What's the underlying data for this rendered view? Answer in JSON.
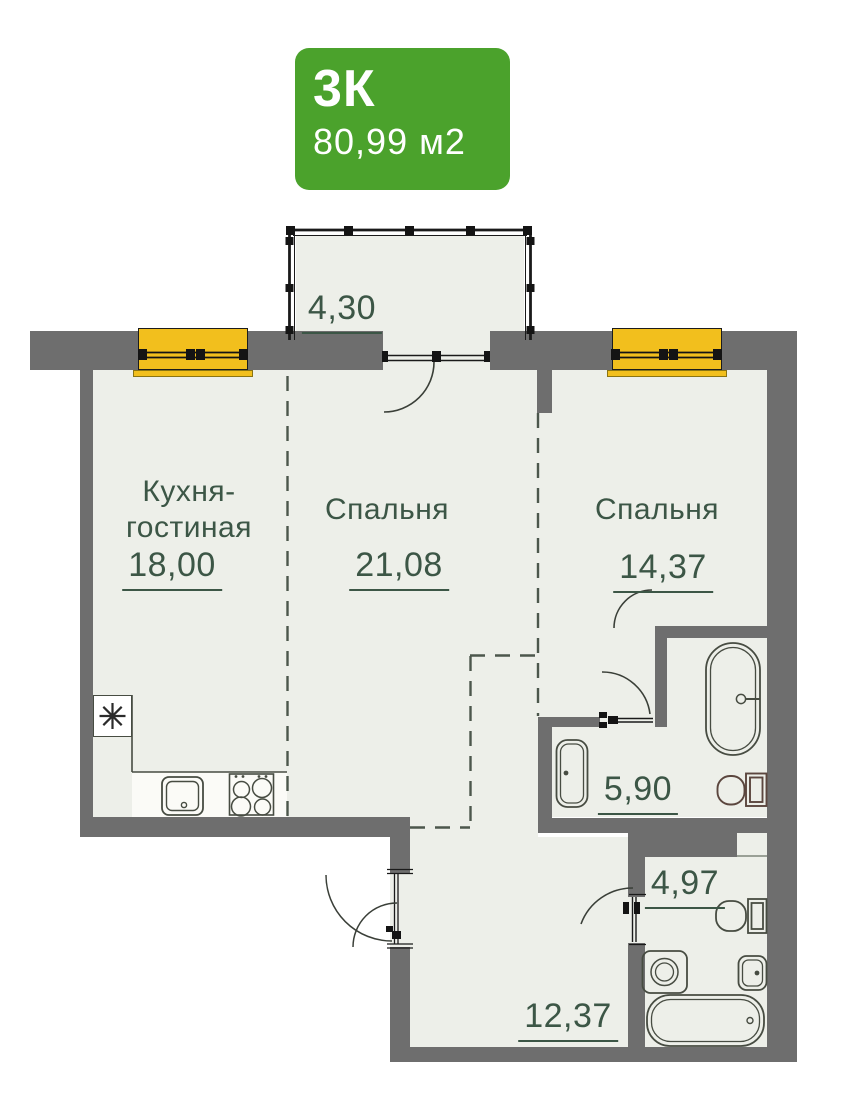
{
  "badge": {
    "type": "3К",
    "area": "80,99 м2"
  },
  "rooms": {
    "kitchen_living": {
      "name_line1": "Кухня-",
      "name_line2": "гостиная",
      "area": "18,00"
    },
    "bedroom_1": {
      "name": "Спальня",
      "area": "21,08"
    },
    "bedroom_2": {
      "name": "Спальня",
      "area": "14,37"
    },
    "balcony": {
      "area": "4,30"
    },
    "bathroom_1": {
      "area": "5,90"
    },
    "bathroom_2": {
      "area": "4,97"
    },
    "hallway": {
      "area": "12,37"
    }
  },
  "fixtures": {
    "kitchen": [
      "ventilation-shaft",
      "kitchen-sink",
      "stove"
    ],
    "bathroom_1": [
      "washbasin",
      "bathtub",
      "toilet"
    ],
    "bathroom_2": [
      "toilet",
      "washing-machine",
      "washbasin",
      "bathtub"
    ]
  },
  "colors": {
    "badge_green": "#4BA22C",
    "wall_gray": "#6E6E6E",
    "floor": "#EDEFE9",
    "window_yellow": "#F2BF1D",
    "label_green": "#3C5646",
    "fixture_outline": "#474C42",
    "toilet_outline_brown": "#5B463E"
  }
}
